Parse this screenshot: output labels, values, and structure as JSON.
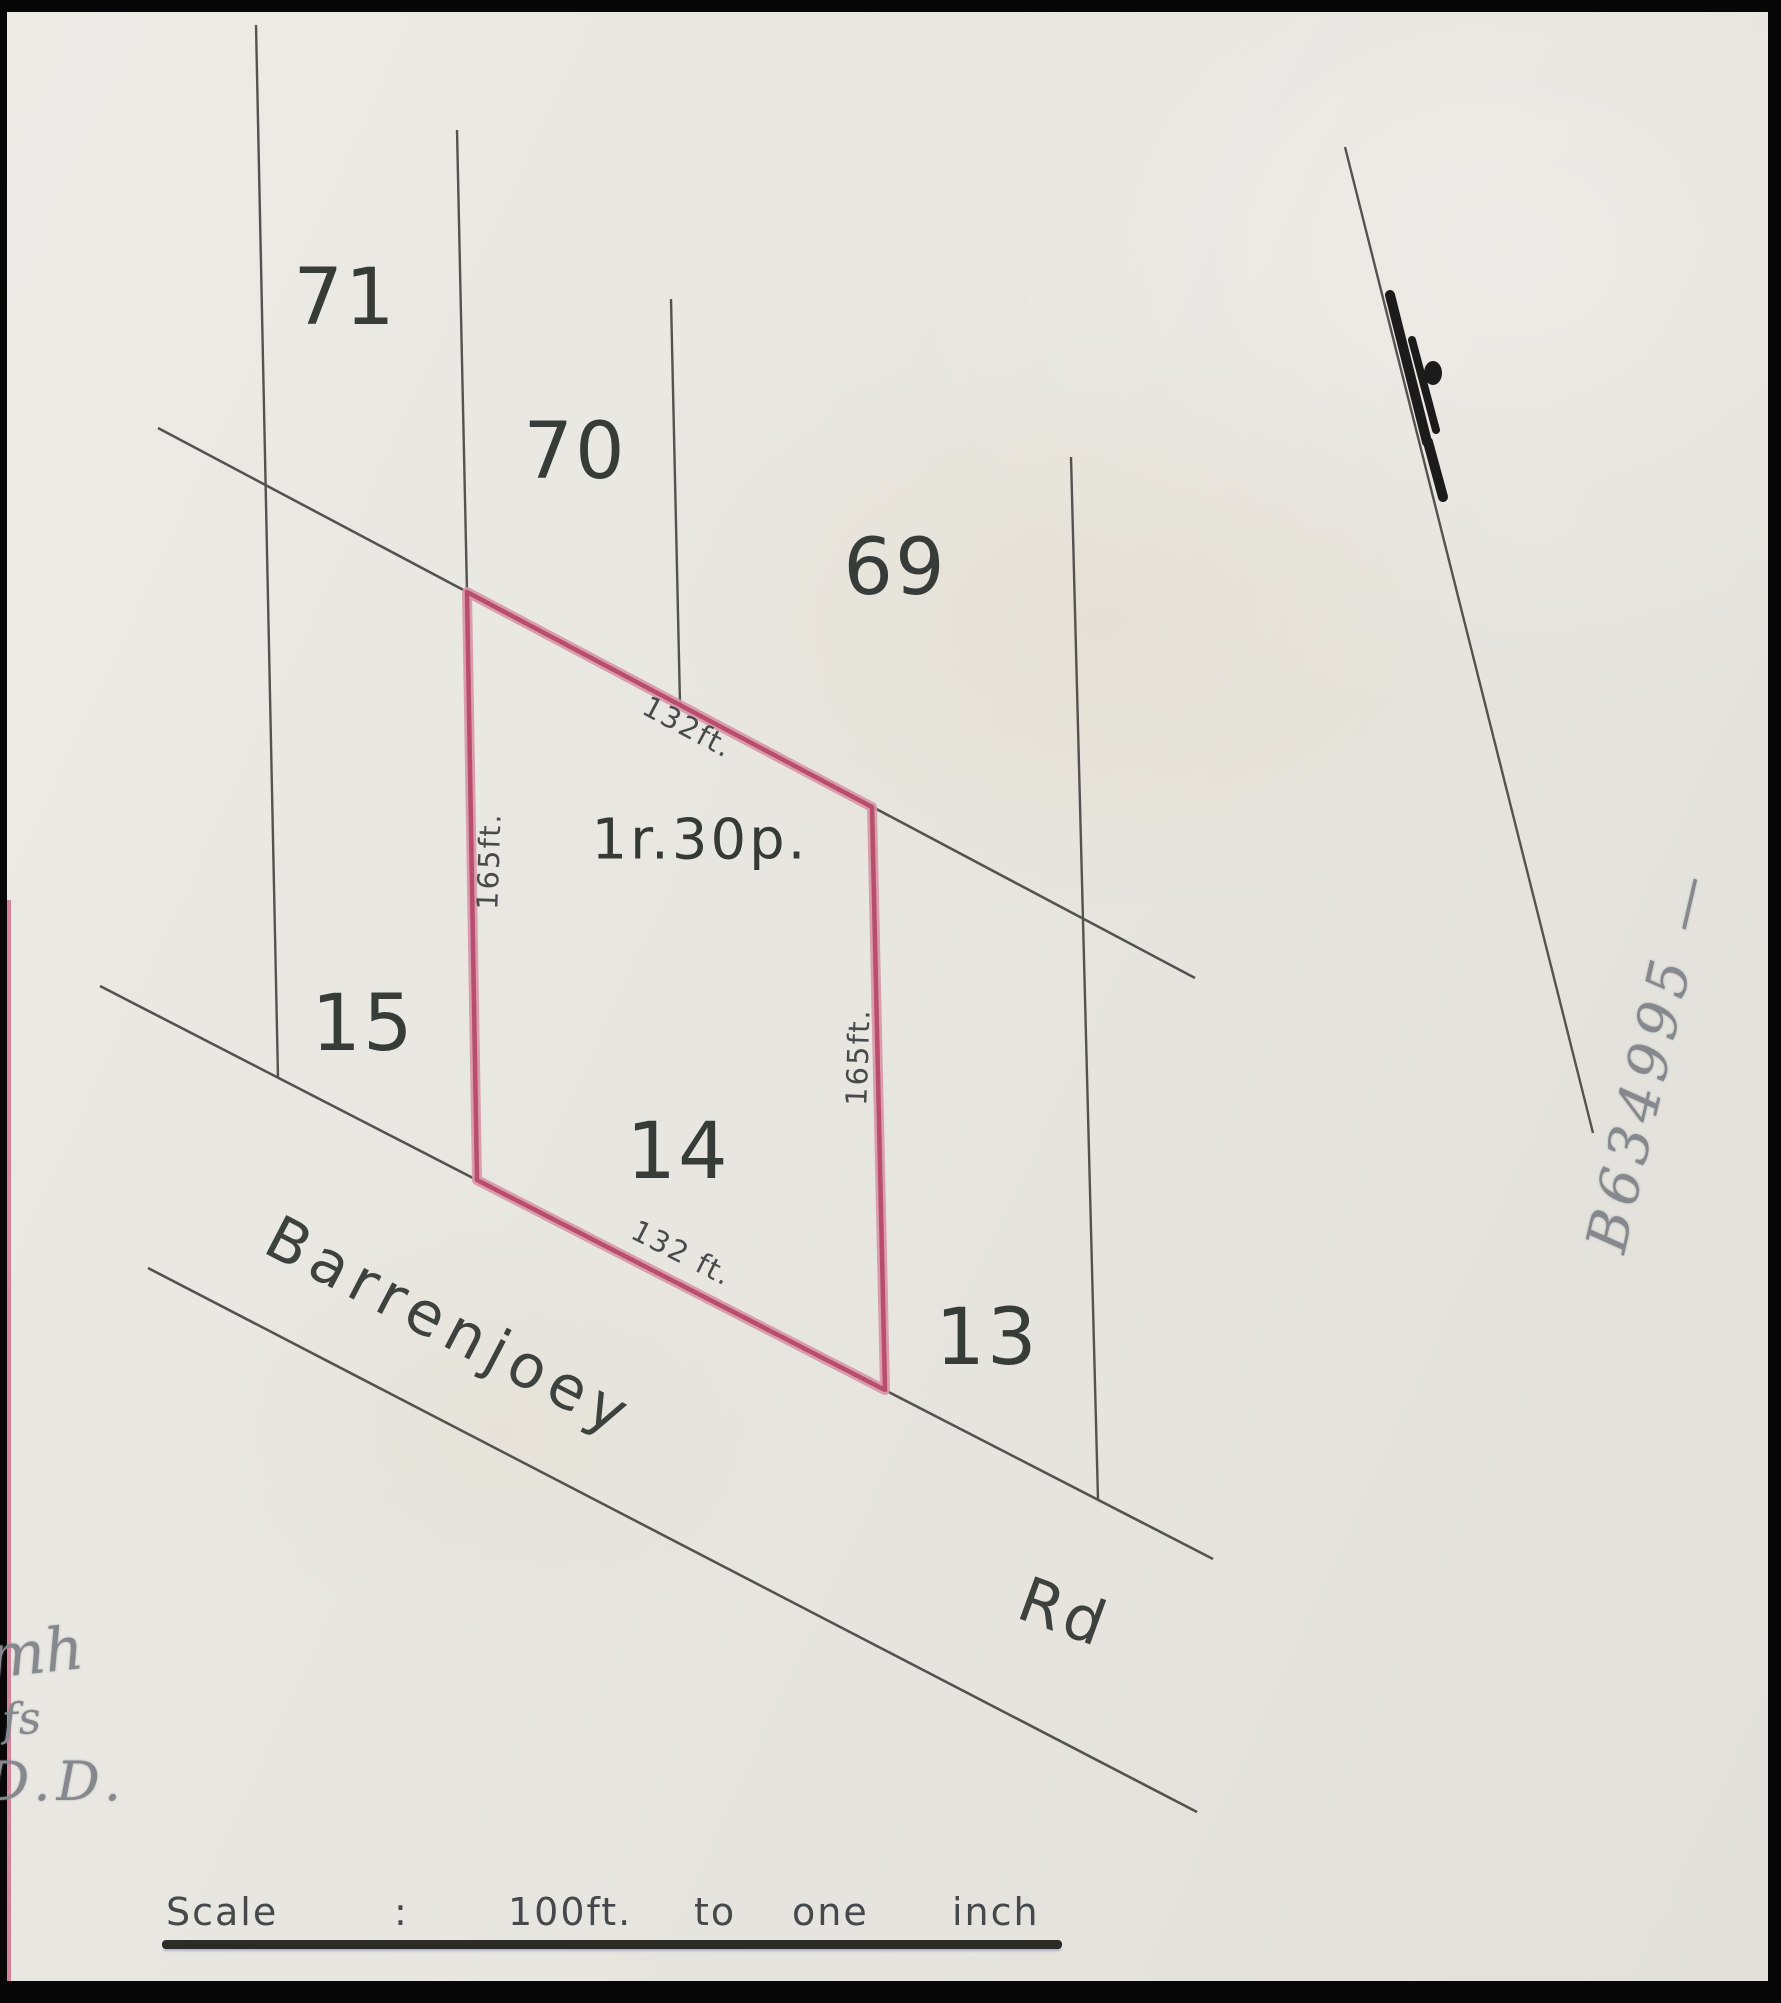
{
  "plan": {
    "lots": [
      {
        "label": "71"
      },
      {
        "label": "70"
      },
      {
        "label": "69"
      },
      {
        "label": "15"
      },
      {
        "label": "14"
      },
      {
        "label": "13"
      }
    ],
    "parcel": {
      "area_label": "1r.30p.",
      "dim_top": "132ft.",
      "dim_bottom": "132 ft.",
      "dim_left": "165ft.",
      "dim_right": "165ft."
    },
    "road": {
      "name": "Barrenjoey",
      "suffix": "Rd"
    },
    "scale_bar": {
      "label": "Scale",
      "colon": ":",
      "value": "100ft.",
      "word_to": "to",
      "word_one": "one",
      "word_inch": "inch"
    },
    "annotations": {
      "reference_pencil": "B634995 —",
      "corner_marks": [
        "mh",
        "fs",
        "D.D."
      ]
    },
    "colors": {
      "parcel_outline": "#b84d6d",
      "parcel_outline_halo": "#d795a9",
      "survey_line": "#55534f",
      "ink": "#373c39",
      "pencil": "#85898e",
      "paper": "#e8e6e0",
      "scan_border": "#070707"
    }
  }
}
